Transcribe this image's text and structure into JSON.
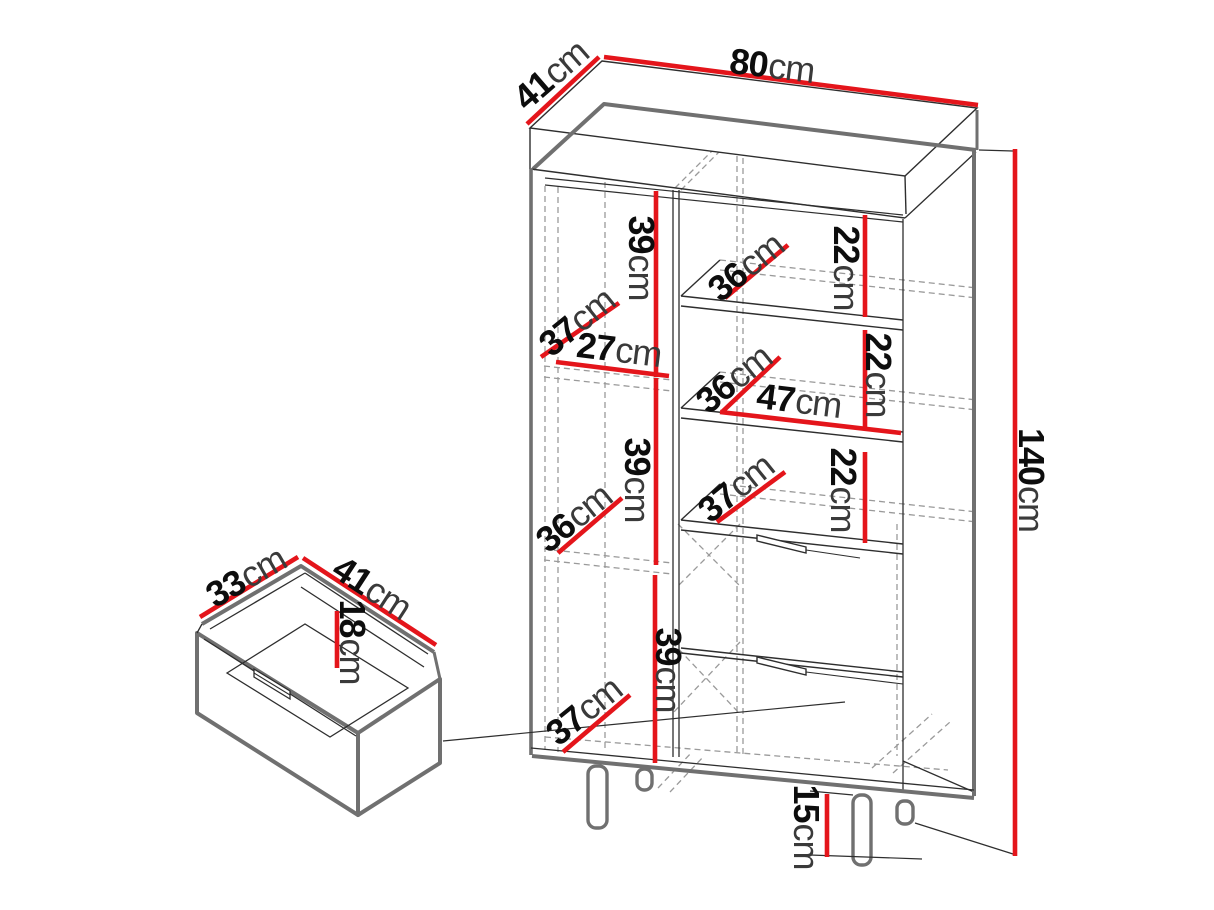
{
  "figure": {
    "kind": "furniture-dimension-diagram",
    "subject": "display cabinet with shelves, two drawers and drawer detail view",
    "unit": "cm"
  },
  "colors": {
    "dimension_red": "#e4151b",
    "outline_dark": "#2e2e2e",
    "edge_gray": "#707070",
    "hidden_dash_gray": "#9a9a9a",
    "background": "#ffffff"
  },
  "overall_dimensions": {
    "width_cm": 80,
    "depth_cm": 41,
    "height_cm": 140,
    "leg_height_cm": 15
  },
  "drawer_dimensions": {
    "depth_cm": 33,
    "width_cm": 41,
    "height_cm": 18
  },
  "labels": {
    "depth_top": {
      "value": "41",
      "unit": "cm"
    },
    "width_top": {
      "value": "80",
      "unit": "cm"
    },
    "height_total": {
      "value": "140",
      "unit": "cm"
    },
    "left_upper_h": {
      "value": "39",
      "unit": "cm"
    },
    "left_upper_d": {
      "value": "37",
      "unit": "cm"
    },
    "left_upper_w": {
      "value": "27",
      "unit": "cm"
    },
    "left_mid_d": {
      "value": "36",
      "unit": "cm"
    },
    "left_mid_h": {
      "value": "39",
      "unit": "cm"
    },
    "left_bottom_d": {
      "value": "37",
      "unit": "cm"
    },
    "left_bottom_h": {
      "value": "39",
      "unit": "cm"
    },
    "shelf_a_d": {
      "value": "36",
      "unit": "cm"
    },
    "shelf_a_h": {
      "value": "22",
      "unit": "cm"
    },
    "shelf_b_d": {
      "value": "36",
      "unit": "cm"
    },
    "shelf_b_w": {
      "value": "47",
      "unit": "cm"
    },
    "shelf_b_h": {
      "value": "22",
      "unit": "cm"
    },
    "shelf_c_d": {
      "value": "37",
      "unit": "cm"
    },
    "shelf_c_h": {
      "value": "22",
      "unit": "cm"
    },
    "legs_h": {
      "value": "15",
      "unit": "cm"
    },
    "drawer_d": {
      "value": "33",
      "unit": "cm"
    },
    "drawer_w": {
      "value": "41",
      "unit": "cm"
    },
    "drawer_h": {
      "value": "18",
      "unit": "cm"
    }
  }
}
